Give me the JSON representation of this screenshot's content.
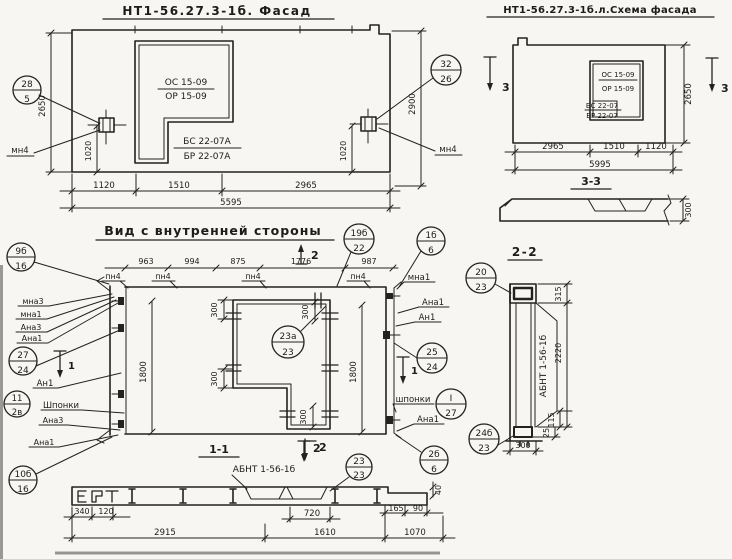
{
  "facade": {
    "title": "НТ1-56.27.3-1б. Фасад",
    "opening": {
      "l1": "ОС 15-09",
      "l2": "ОР 15-09",
      "l3": "БС 22-07А",
      "l4": "БР 22-07А"
    },
    "callout_left": {
      "top": "28",
      "bot": "5"
    },
    "callout_right": {
      "top": "32",
      "bot": "26"
    },
    "anchor_left": "мн4",
    "anchor_right": "мн4",
    "dim_left": "2650",
    "dim_right": "2900",
    "dim_1020l": "1020",
    "dim_1020r": "1020",
    "dims": [
      "1120",
      "1510",
      "2965"
    ],
    "total": "5595"
  },
  "schema": {
    "title": "НТ1-56.27.3-1б.л.Схема фасада",
    "opening": {
      "l1": "ОС 15-09",
      "l2": "ОР 15-09",
      "l3": "БС 22-07",
      "l4": "БР 22-07"
    },
    "dim_right": "2650",
    "dims": [
      "2965",
      "1510",
      "1120"
    ],
    "total": "5995",
    "sec_left": "3",
    "sec_right": "3"
  },
  "sec33": {
    "title": "3-3",
    "thickness": "300"
  },
  "inner": {
    "title": "Вид с внутренней стороны",
    "dims_top": [
      "963",
      "994",
      "875",
      "1776",
      "987"
    ],
    "pn4": "пн4",
    "mna1_top": "мна1",
    "callouts": {
      "c19": {
        "top": "19б",
        "bot": "22"
      },
      "c1b": {
        "top": "1б",
        "bot": "6"
      },
      "c9b": {
        "top": "9б",
        "bot": "16"
      },
      "c27": {
        "top": "27",
        "bot": "24"
      },
      "c11": {
        "top": "11",
        "bot": "2в"
      },
      "c10": {
        "top": "10б",
        "bot": "16"
      },
      "c23a": {
        "top": "23а",
        "bot": "23"
      },
      "c25": {
        "top": "25",
        "bot": "24"
      },
      "cI": {
        "top": "I",
        "bot": "27"
      },
      "c2b": {
        "top": "2б",
        "bot": "6"
      }
    },
    "left": [
      "мна3",
      "мна1",
      "Ана3",
      "Ана1",
      "Ан1",
      "Шпонки",
      "Ана3",
      "Ана1"
    ],
    "right": [
      "Ана1",
      "Ан1",
      "шпонки",
      "Ана1"
    ],
    "sec1": "1",
    "sec2": "2",
    "dim300": "300",
    "dim1800": "1800"
  },
  "sec11": {
    "title": "1-1",
    "sec2": "2",
    "label": "АБНТ 1-56-1б",
    "callout": {
      "top": "23",
      "bot": "23"
    },
    "dims_small": [
      "340",
      "120"
    ],
    "dim720": "720",
    "dims": [
      "2915",
      "1610",
      "1070"
    ],
    "dim165": "165",
    "dim90": "90",
    "dim40": "40"
  },
  "sec22": {
    "title": "2-2",
    "label": "АБНТ 1-56-1б",
    "callout_top": {
      "top": "20",
      "bot": "23"
    },
    "callout_bot": {
      "top": "24б",
      "bot": "23"
    },
    "dim315": "315",
    "dim2220": "2220",
    "dim115": "115",
    "dim25": "25",
    "dim300": "300"
  }
}
